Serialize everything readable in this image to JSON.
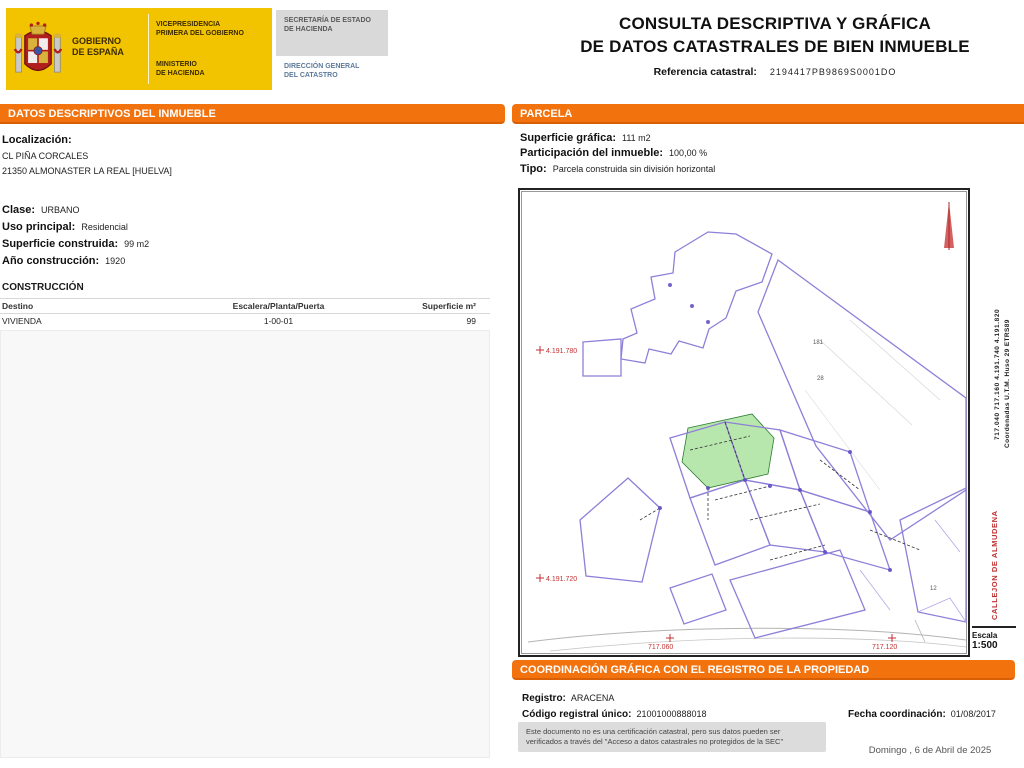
{
  "header": {
    "logo": {
      "gobierno_line1": "GOBIERNO",
      "gobierno_line2": "DE ESPAÑA",
      "vice_line1": "VICEPRESIDENCIA",
      "vice_line2": "PRIMERA DEL GOBIERNO",
      "ministerio_line1": "MINISTERIO",
      "ministerio_line2": "DE HACIENDA",
      "secretaria_line1": "SECRETARÍA DE ESTADO",
      "secretaria_line2": "DE HACIENDA",
      "direccion_line1": "DIRECCIÓN GENERAL",
      "direccion_line2": "DEL CATASTRO"
    },
    "title_line1": "CONSULTA DESCRIPTIVA Y GRÁFICA",
    "title_line2": "DE DATOS CATASTRALES DE BIEN INMUEBLE",
    "ref_label": "Referencia catastral:",
    "ref_value": "2194417PB9869S0001DO"
  },
  "datos": {
    "section_title": "DATOS DESCRIPTIVOS DEL INMUEBLE",
    "localizacion": {
      "label": "Localización:",
      "line1": "CL PIÑA CORCALES",
      "line2": "21350 ALMONASTER LA REAL [HUELVA]"
    },
    "clase": {
      "label": "Clase:",
      "value": "URBANO"
    },
    "uso": {
      "label": "Uso principal:",
      "value": "Residencial"
    },
    "superficie": {
      "label": "Superficie construida:",
      "value": "99 m2"
    },
    "anio": {
      "label": "Año construcción:",
      "value": "1920"
    },
    "construccion": {
      "title": "CONSTRUCCIÓN",
      "columns": [
        "Destino",
        "Escalera/Planta/Puerta",
        "Superficie m²"
      ],
      "row": {
        "destino": "VIVIENDA",
        "escalera": "1-00-01",
        "superficie": "99"
      }
    }
  },
  "parcela": {
    "section_title": "PARCELA",
    "superficie_grafica": {
      "label": "Superficie gráfica:",
      "value": "111 m2"
    },
    "participacion": {
      "label": "Participación del inmueble:",
      "value": "100,00 %"
    },
    "tipo": {
      "label": "Tipo:",
      "value": "Parcela construida sin división horizontal"
    }
  },
  "map": {
    "labels": {
      "northing_upper": "4.191.780",
      "northing_lower": "4.191.720",
      "easting_left": "717.060",
      "easting_right": "717.120"
    },
    "tiny_labels": [
      "181",
      "28",
      "12"
    ],
    "margin": {
      "coords_line1": "Coordenadas U.T.M. Huso 29 ETRS89",
      "coords_line2": "717.040  717.160  4.191.740  4.191.820",
      "red_label": "CALLEJON DE ALMUDENA",
      "escala_label": "Escala",
      "escala_value": "1:500"
    }
  },
  "coordinacion": {
    "section_title": "COORDINACIÓN GRÁFICA CON EL REGISTRO DE LA PROPIEDAD",
    "registro": {
      "label": "Registro:",
      "value": "ARACENA"
    },
    "codigo": {
      "label": "Código registral único:",
      "value": "21001000888018"
    },
    "fecha": {
      "label": "Fecha coordinación:",
      "value": "01/08/2017"
    },
    "disclaimer_line1": "Este documento no es una certificación catastral, pero sus datos pueden ser",
    "disclaimer_line2": "verificados a través del \"Acceso a datos catastrales no protegidos de la SEC\""
  },
  "footer": {
    "date": "Domingo , 6 de Abril de 2025"
  },
  "colors": {
    "accent_orange": "#f2720e",
    "logo_yellow": "#f2c400",
    "parcel_purple": "#8f7fd8",
    "highlight_green": "#b7e7ad",
    "coordinate_red": "#c23131"
  }
}
